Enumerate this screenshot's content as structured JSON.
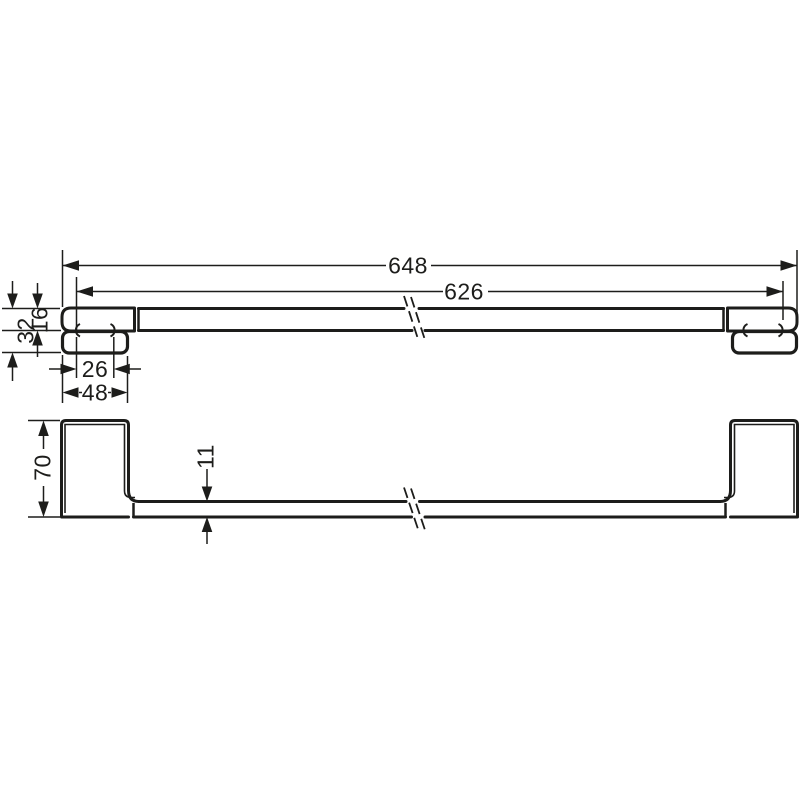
{
  "meta": {
    "type": "technical-drawing",
    "subject": "Wall-mounted towel bar, two-view dimensioned drawing",
    "units": "mm",
    "background_color": "#ffffff",
    "line_color": "#1d1d1b"
  },
  "views": {
    "top": {
      "label": "top view",
      "dims": {
        "overall_length": "648",
        "mounting_centers": "626",
        "total_depth": "32",
        "rail_depth": "16",
        "plate_hole_spacing": "26",
        "plate_width": "48"
      }
    },
    "front": {
      "label": "front view",
      "dims": {
        "bracket_height": "70",
        "rail_thickness": "11"
      }
    }
  }
}
